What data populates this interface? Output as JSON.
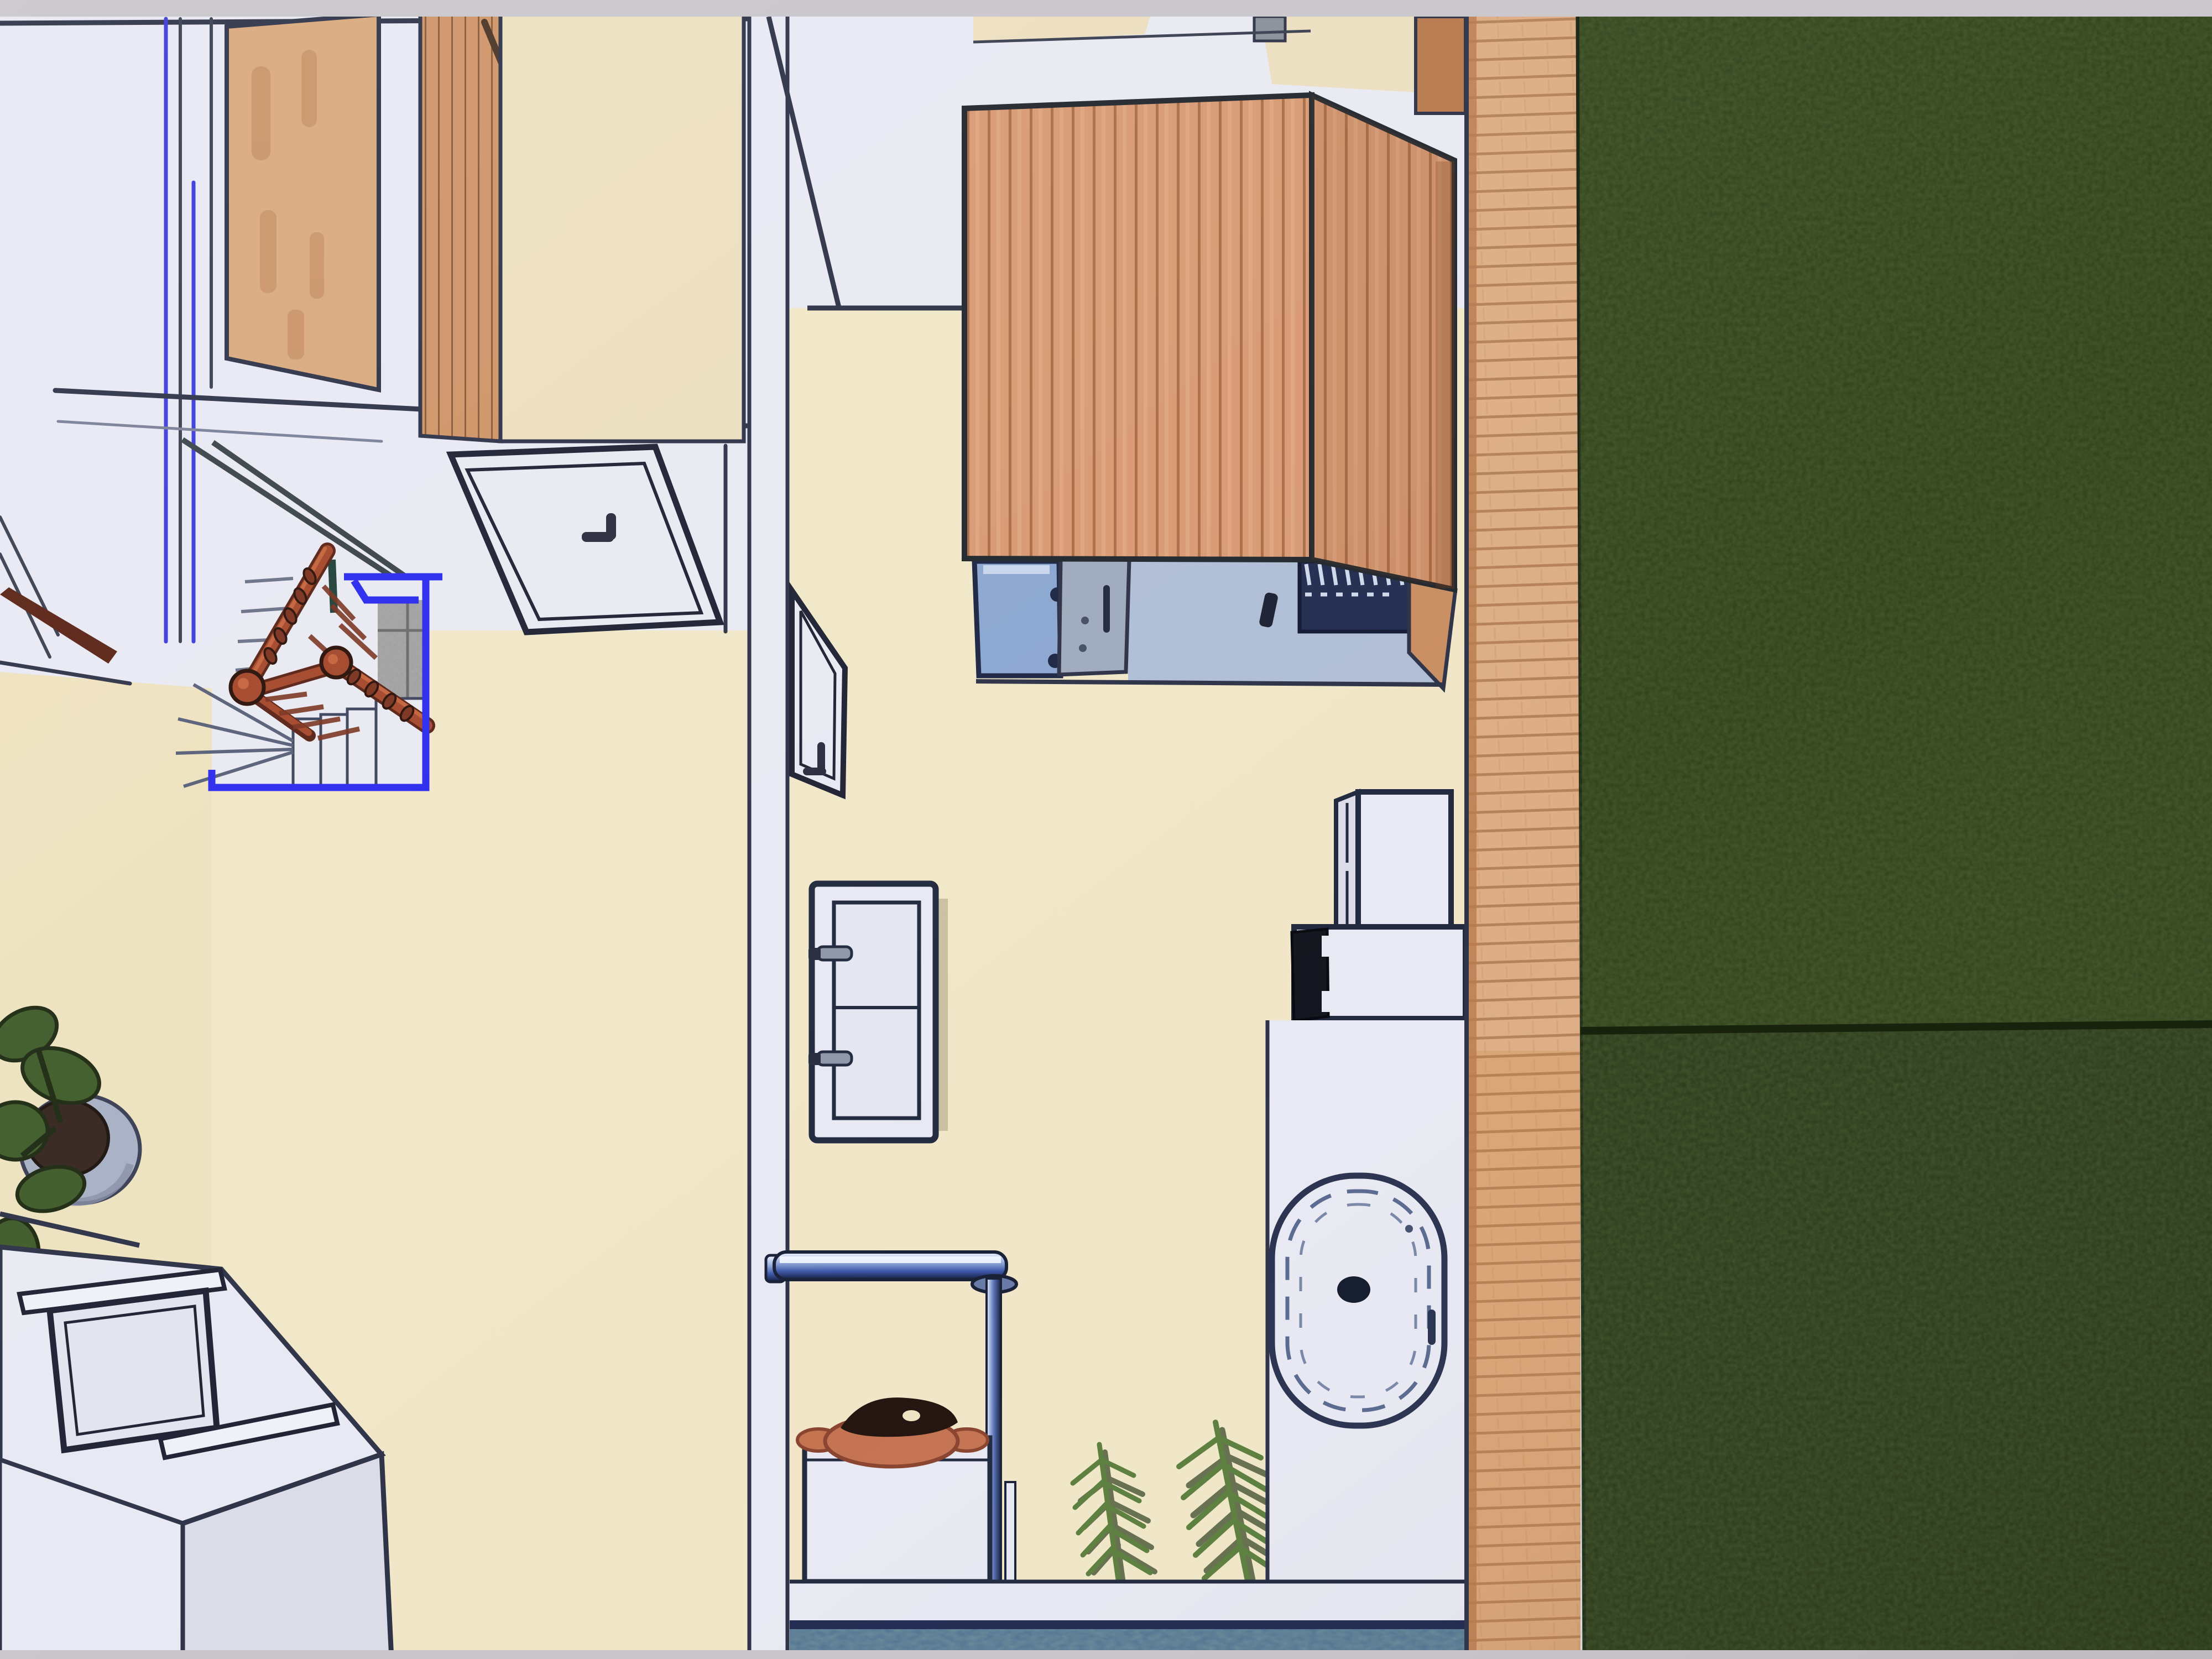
{
  "app": {
    "type": "3d-home-design-top-view-render",
    "selection": {
      "object": "staircase",
      "outline_color": "#2a2aee",
      "selected": true
    }
  },
  "colors": {
    "photoEdge": "#c9c6cc",
    "wallWhite": "#e9e9f3",
    "wallShade": "#dcdce8",
    "outline": "#2e3348",
    "creamFloor": "#f1e7c8",
    "creamFloorDeep": "#eee2bf",
    "woodPanel": "#d9a97e",
    "woodGrain": "#c28a5e",
    "woodSlats": "#cf9468",
    "sidePanelCream": "#ecdfc0",
    "saunaWood": "#d89a74",
    "saunaSeam": "#a96f48",
    "deckWood": "#ddae86",
    "deckSeam": "#b5825a",
    "deckEdge": "#b97a4e",
    "grassTop": "#2f4019",
    "grassBottom": "#293818",
    "grassSeam": "#15200a",
    "railingRed": "#a4472a",
    "railingHighlight": "#c4633c",
    "railingDark": "#5a2315",
    "selectionBlue": "#2a2aee",
    "accentBlue": "#3b3bdd",
    "stoneGray": "#9c9c9c",
    "stoneSeam": "#6a6a6a",
    "glassBlue": "#8ca7d0",
    "showerDoorGray": "#9fabbd",
    "benchNavy": "#242e52",
    "benchSlat": "#cfd9ea",
    "interiorFloorBlue": "#b0bed6",
    "terracotta": "#c57452",
    "bowlDark": "#241510",
    "tileBlue": "#4f7092",
    "tileTeal": "#3f6a5a",
    "plantLeaf": "#3f5c2a",
    "plantPot": "#a8b0c4",
    "plantSoil": "#362620",
    "palmGreen": "#5d8040",
    "palmShadow": "#2e4020",
    "stepLine": "#586078"
  },
  "scene": {
    "rooms": [
      {
        "name": "upper-left-room",
        "objects": [
          "wardrobe",
          "interior-door",
          "staircase",
          "railing",
          "stone-landing"
        ]
      },
      {
        "name": "lower-left-room",
        "objects": [
          "potted-plant",
          "stair-enclosure",
          "skylight-window"
        ]
      },
      {
        "name": "bathroom-corridor",
        "objects": [
          "open-door",
          "sauna-cabin",
          "shower-glass",
          "sauna-bench",
          "vanity-cabinet",
          "towel-bar",
          "shower-pole",
          "bath-bench",
          "terracotta-bowl",
          "palm-plants",
          "tall-cabinet",
          "washer-unit",
          "bathtub"
        ]
      },
      {
        "name": "exterior",
        "objects": [
          "wood-deck",
          "lawn"
        ]
      }
    ]
  }
}
